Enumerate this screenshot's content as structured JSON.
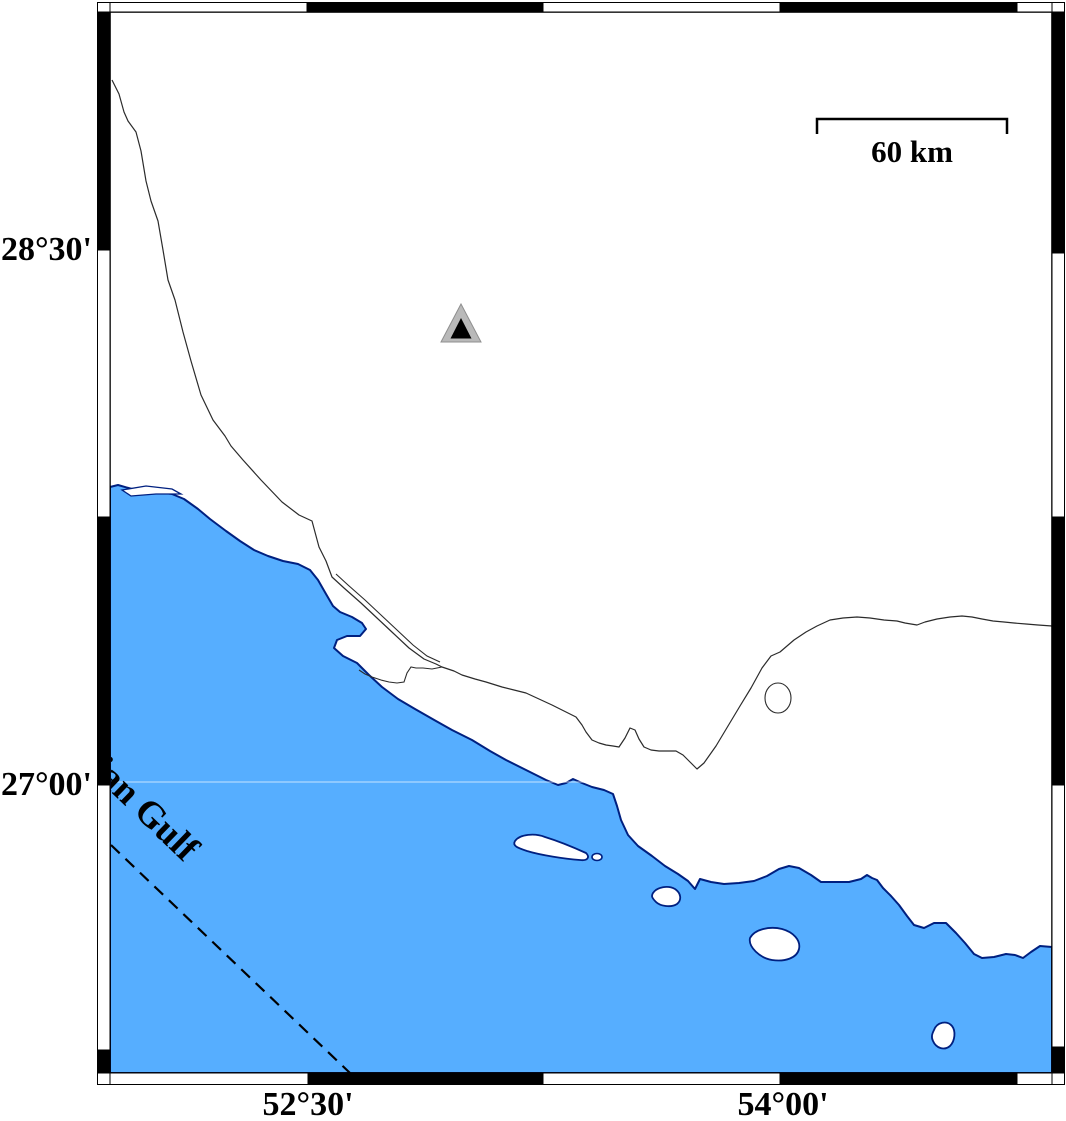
{
  "figure": {
    "type": "coastal-map",
    "sea_label": "Persian Gulf",
    "axis": {
      "left": [
        {
          "text": "28°30'"
        },
        {
          "text": "27°00'"
        }
      ],
      "bottom": [
        {
          "text": "52°30'"
        },
        {
          "text": "54°00'"
        }
      ]
    },
    "scale_bar": {
      "label": "60 km",
      "length_km": 60
    },
    "marker": {
      "shape": "triangle",
      "meaning": "station-marker"
    },
    "colors": {
      "sea": "#56AEFF",
      "coastline": "#002080",
      "frame": "#000000",
      "boundary_line": "#2b2b2b",
      "marker_outer": "#B9B9B9",
      "marker_inner": "#000000"
    }
  }
}
